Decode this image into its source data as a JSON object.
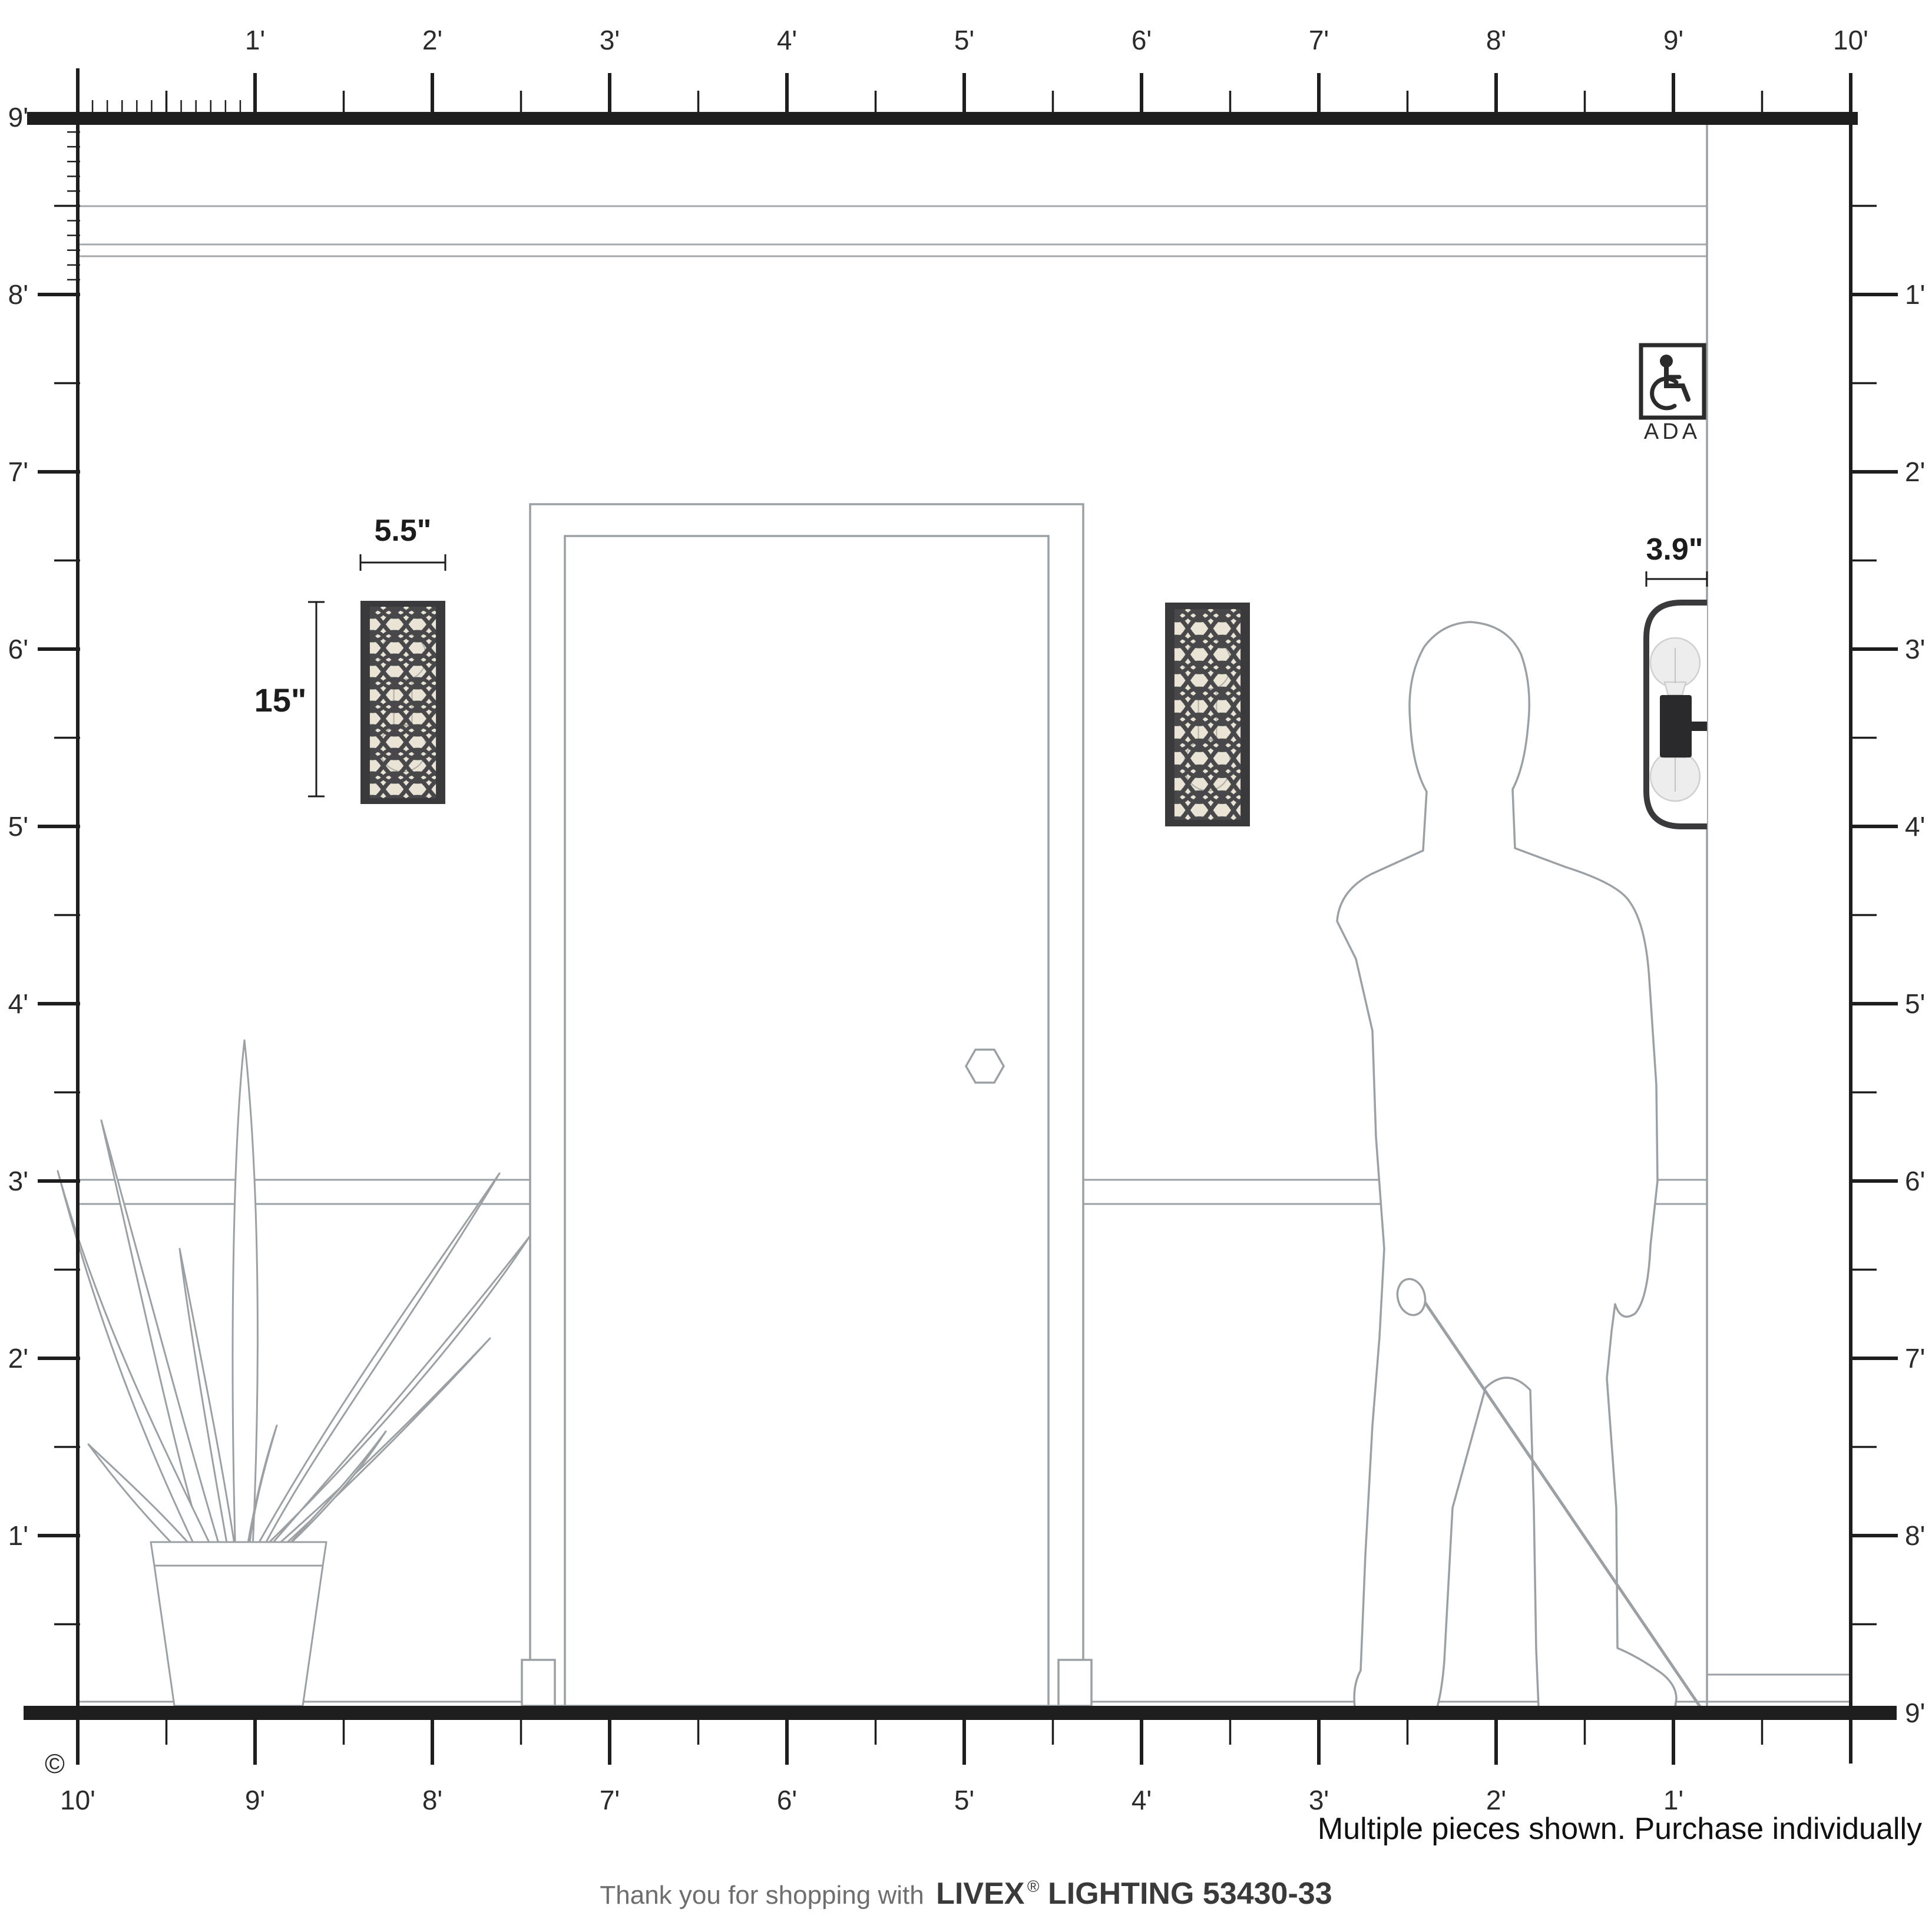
{
  "colors": {
    "ink": "#231f20",
    "line_gray": "#9aa0a4",
    "sconce_frame": "#3a3a3c",
    "sconce_pattern": "#48484a",
    "diffuser": "#eae4d6",
    "bulb_fill": "#ededed",
    "bulb_stroke": "#cfcfcf",
    "socket_black": "#2a2a2c"
  },
  "rulers": {
    "top_labels": [
      "1'",
      "2'",
      "3'",
      "4'",
      "5'",
      "6'",
      "7'",
      "8'",
      "9'",
      "10'"
    ],
    "left_labels": [
      "9'",
      "8'",
      "7'",
      "6'",
      "5'",
      "4'",
      "3'",
      "2'",
      "1'"
    ],
    "right_labels": [
      "1'",
      "2'",
      "3'",
      "4'",
      "5'",
      "6'",
      "7'",
      "8'",
      "9'"
    ],
    "bottom_labels": [
      "10'",
      "9'",
      "8'",
      "7'",
      "6'",
      "5'",
      "4'",
      "3'",
      "2'",
      "1'"
    ]
  },
  "dimensions": {
    "sconce_width": "5.5\"",
    "sconce_height": "15\"",
    "sconce_depth": "3.9\""
  },
  "ada": {
    "label": "ADA"
  },
  "copyright": "©",
  "note": "Multiple pieces shown. Purchase individually",
  "footer": {
    "prefix": "Thank you for shopping with",
    "brand": "LIVEX",
    "reg": "®",
    "product": "LIGHTING 53430-33"
  }
}
